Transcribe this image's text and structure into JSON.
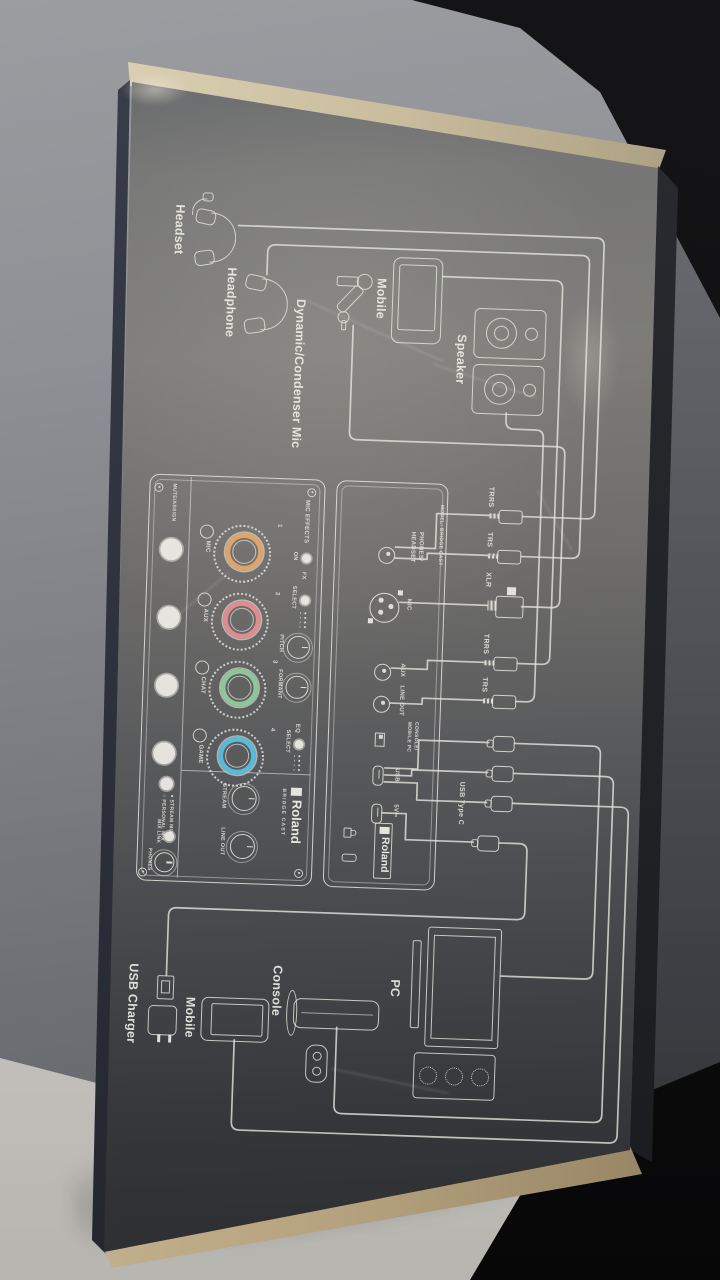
{
  "scene": {
    "colors": {
      "wall_grey": "#8f9196",
      "backdrop_black": "#0b0b0d",
      "table_light": "#c6c4bf",
      "box_face_light": "#7d7c79",
      "box_face_dark": "#2a2c2f",
      "box_lid_cream": "#d8cbae",
      "box_bottom_cardboard": "#c2ae8c",
      "box_side_navy": "#2a2d34",
      "diagram_line": "#e4e2da"
    }
  },
  "diagram": {
    "peripherals": {
      "headset": "Headset",
      "headphone": "Headphone",
      "mic": "Dynamic/Condenser Mic",
      "mobile": "Mobile",
      "speaker": "Speaker"
    },
    "plugs": {
      "trrs_a": "TRRS",
      "trs_a": "TRS",
      "xlr": "XLR",
      "trrs_b": "TRRS",
      "trs_b": "TRS",
      "usb_type_c": "USB Type C"
    },
    "rear_panel": {
      "model": "MODEL: BRIDGE CAST",
      "phones_line1": "PHONES/",
      "phones_line2": "HEADSET",
      "mic": "MIC",
      "aux": "AUX",
      "line_out": "LINE OUT",
      "switch_line1": "CONSOLE/",
      "switch_line2": "MOBILE  PC",
      "usb": "USB",
      "power": "5V⎓",
      "brand": "Roland"
    },
    "top_panel": {
      "mute_assign": "MUTE/ASSIGN",
      "mic_effects": "MIC EFFECTS",
      "on": "ON",
      "fx": "FX",
      "select": "SELECT",
      "pitch": "PITCH",
      "formant": "FORMANT",
      "eq": "EQ",
      "select2": "SELECT",
      "channels": [
        {
          "num": "1",
          "label": "MIC",
          "color": "#e0a468"
        },
        {
          "num": "2",
          "label": "AUX",
          "color": "#df8b90"
        },
        {
          "num": "3",
          "label": "CHAT",
          "color": "#8bc79b"
        },
        {
          "num": "4",
          "label": "GAME",
          "color": "#57bad9"
        }
      ],
      "stream": "STREAM",
      "line_out": "LINE OUT",
      "mix_link": "MIX LINK",
      "phones": "PHONES",
      "stream_mix": "● STREAM MIX",
      "personal_mix": "○ PERSONAL MIX",
      "brand": "Roland",
      "product": "BRIDGE CAST"
    },
    "hosts": {
      "pc": "PC",
      "console": "Console",
      "mobile": "Mobile",
      "usb_charger": "USB Charger"
    }
  }
}
